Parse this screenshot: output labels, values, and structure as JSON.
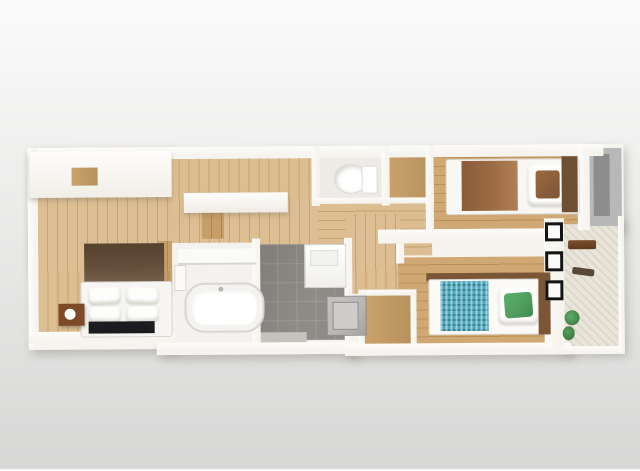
{
  "scene": {
    "kind": "3d-floorplan-top-down-render",
    "text_content": "none",
    "bg-top": "#fbfbfb",
    "bg-bottom": "#d7d7d6"
  },
  "palette": {
    "bg-top": "#fbfbfb",
    "bg-bottom": "#d7d7d6",
    "wall-white": "#f6f4ef",
    "wood-light": "#dcbe92",
    "wood-light-line": "#c6a26e",
    "wood-mid": "#d0a873",
    "wood-mid-line": "#ba9059",
    "wood-closet": "#c9a36b",
    "tile-grey": "#8f8b87",
    "mat-grey": "#c6c3be",
    "bath-white": "#f3f2ee",
    "fixture-line": "#d8d6d1",
    "accent-brown": "#64503c",
    "headboard-brown": "#6f4f33",
    "frame-brown": "#7a5636",
    "duvet-brown": "#9c6b44",
    "duvet-teal": "#4fa8bd",
    "pillow-green": "#4f9d5e",
    "rug-black": "#1b1b20",
    "nightstand-brown": "#7c4a26",
    "appliance-grey": "#b9b7b3",
    "appliance-edge": "#8f8d89",
    "balcony-floor": "#eae5da",
    "window-black": "#141414",
    "glass-grey": "#8d8d8d",
    "panel-grey": "#b8b8b8",
    "plant-green": "#4a8a50",
    "plant-green-dark": "#336b3a",
    "shadow": "rgba(105,100,90,0.30)"
  },
  "rooms": [
    {
      "id": "ldk-main-bedroom",
      "floor": "light wood planks",
      "furniture": [
        "wall-cabinet",
        "kitchen-counter",
        "accent-wall",
        "double-bed",
        "nightstand",
        "table-lamp",
        "floor-rug"
      ]
    },
    {
      "id": "bathroom",
      "floor": "white unit bath",
      "furniture": [
        "bathtub",
        "bath-counter"
      ]
    },
    {
      "id": "washroom-entrance",
      "floor": "grey tile",
      "furniture": [
        "vanity-sink",
        "washing-machine",
        "entrance-mat"
      ]
    },
    {
      "id": "toilet-room",
      "floor": "white",
      "furniture": [
        "toilet"
      ]
    },
    {
      "id": "upper-closet",
      "floor": "wood",
      "furniture": []
    },
    {
      "id": "bedroom-north",
      "floor": "wood planks",
      "furniture": [
        "single-bed-brown"
      ]
    },
    {
      "id": "corridor",
      "floor": "wood planks",
      "furniture": []
    },
    {
      "id": "lower-closet",
      "floor": "wood",
      "furniture": []
    },
    {
      "id": "bedroom-south",
      "floor": "wood planks",
      "furniture": [
        "single-bed-teal"
      ]
    },
    {
      "id": "balcony",
      "floor": "textured cream",
      "furniture": [
        "coat-rack",
        "wall-hook",
        "potted-plant",
        "window",
        "window",
        "window",
        "glass-panel"
      ]
    }
  ]
}
